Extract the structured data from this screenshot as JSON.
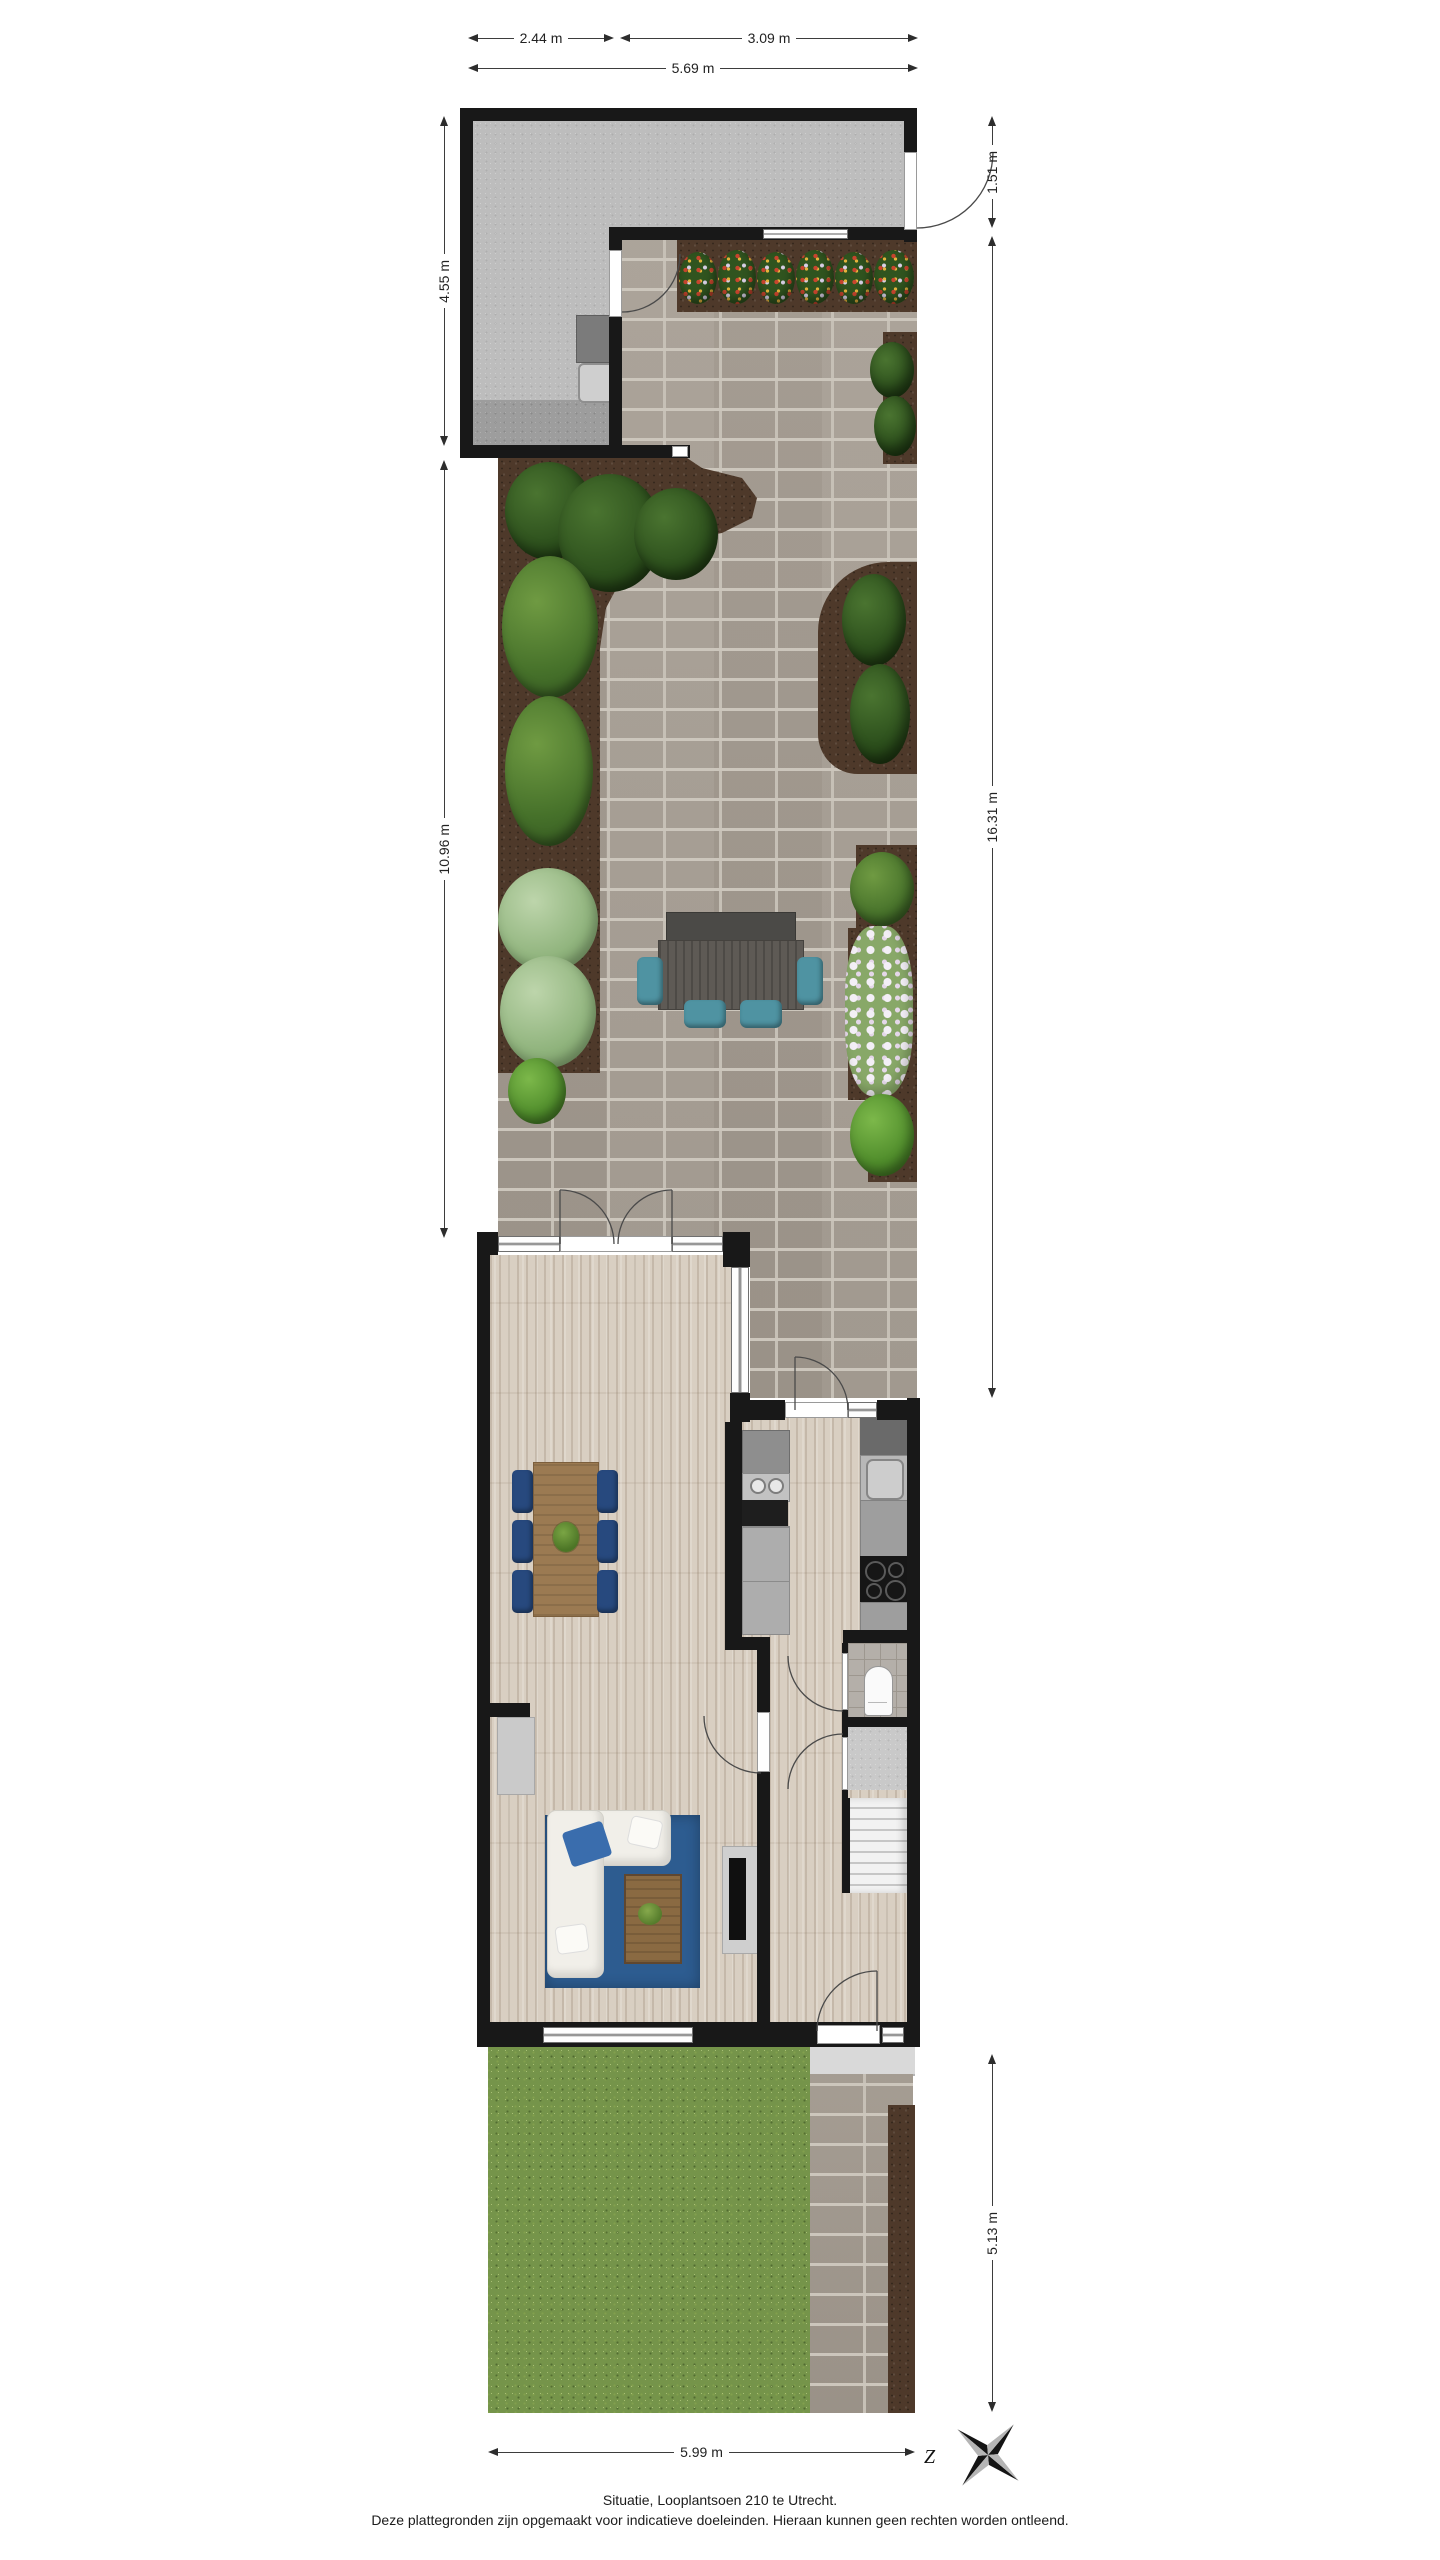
{
  "caption": {
    "line1": "Situatie, Looplantsoen 210 te Utrecht.",
    "line2": "Deze plattegronden zijn opgemaakt voor indicatieve doeleinden. Hieraan kunnen geen rechten worden ontleend."
  },
  "dimensions": {
    "top_left": "2.44 m",
    "top_right": "3.09 m",
    "top_total": "5.69 m",
    "left_shed": "4.55 m",
    "left_garden": "10.96 m",
    "right_shed": "1.51 m",
    "right_garden": "16.31 m",
    "right_front": "5.13 m",
    "bottom": "5.99 m"
  },
  "compass": {
    "south_label": "Z"
  },
  "palette": {
    "wall": "#181818",
    "shed_floor": "#bdbdbd",
    "brick_path": "#a8a096",
    "soil": "#4e392a",
    "grass": "#75944a",
    "wood_floor": "#d9cfc2",
    "rug": "#2d5c90",
    "sofa": "#f1efe9",
    "dining_chair": "#27497e",
    "garden_chair": "#4f93a2",
    "dining_table": "#9b7a52",
    "coffee_table": "#8a6a42",
    "garden_table": "#5e5a55",
    "stairs": "#ededed"
  }
}
